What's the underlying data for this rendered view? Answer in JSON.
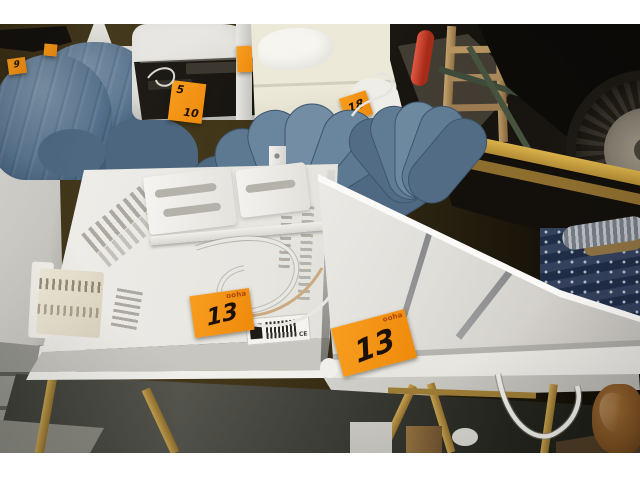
{
  "photo": {
    "lot_stickers": {
      "brand": "ooha",
      "entries": [
        {
          "location": "blue tub chair",
          "number": "9"
        },
        {
          "location": "device on chair",
          "number": "5"
        },
        {
          "location": "device on chair",
          "number": "10"
        },
        {
          "location": "massage table",
          "number": "18"
        },
        {
          "location": "panel heater back",
          "number": "13"
        },
        {
          "location": "panel heater front",
          "number": "13"
        }
      ]
    },
    "heater_label_ce": "CE"
  },
  "palette": {
    "sticker_orange": "#f6920f",
    "velvet_blue": "#5d7991",
    "heater_white": "#efede9",
    "stripe_gray": "#8f8f92",
    "brass_gold": "#a8843c",
    "wall_olive": "#3f3318",
    "plank_yellow": "#c9a23c",
    "ring_navy": "#2b3852",
    "handle_red": "#c23a24"
  }
}
